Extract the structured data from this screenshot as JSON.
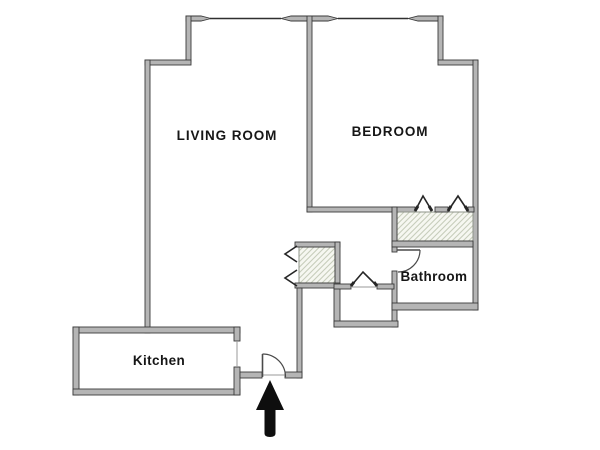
{
  "plan": {
    "type": "apartment-floor-plan",
    "rooms": {
      "living_room": "LIVING ROOM",
      "bedroom": "BEDROOM",
      "bathroom": "Bathroom",
      "kitchen": "Kitchen"
    },
    "features": {
      "entrance_arrow_direction": "up",
      "closets_hatched": 2,
      "windows_top_wall": 2,
      "doors": [
        "entry-swing-door",
        "bathroom-swing-door",
        "bedroom-bifold-closet-doors",
        "hall-bifold-closet-doors",
        "walkin-closet-bifold-door"
      ]
    }
  },
  "colors": {
    "background": "#ffffff",
    "wall_fill": "#b5b5b5",
    "wall_stroke": "#3a3a3a",
    "thin_line": "#2f2f2f",
    "hatch_line": "#c7cdbb",
    "hatch_bg": "#f6f7f1",
    "door_arc": "#4a4a4a",
    "chevron": "#262626",
    "arrow": "#0e0e0e",
    "label": "#161616"
  }
}
